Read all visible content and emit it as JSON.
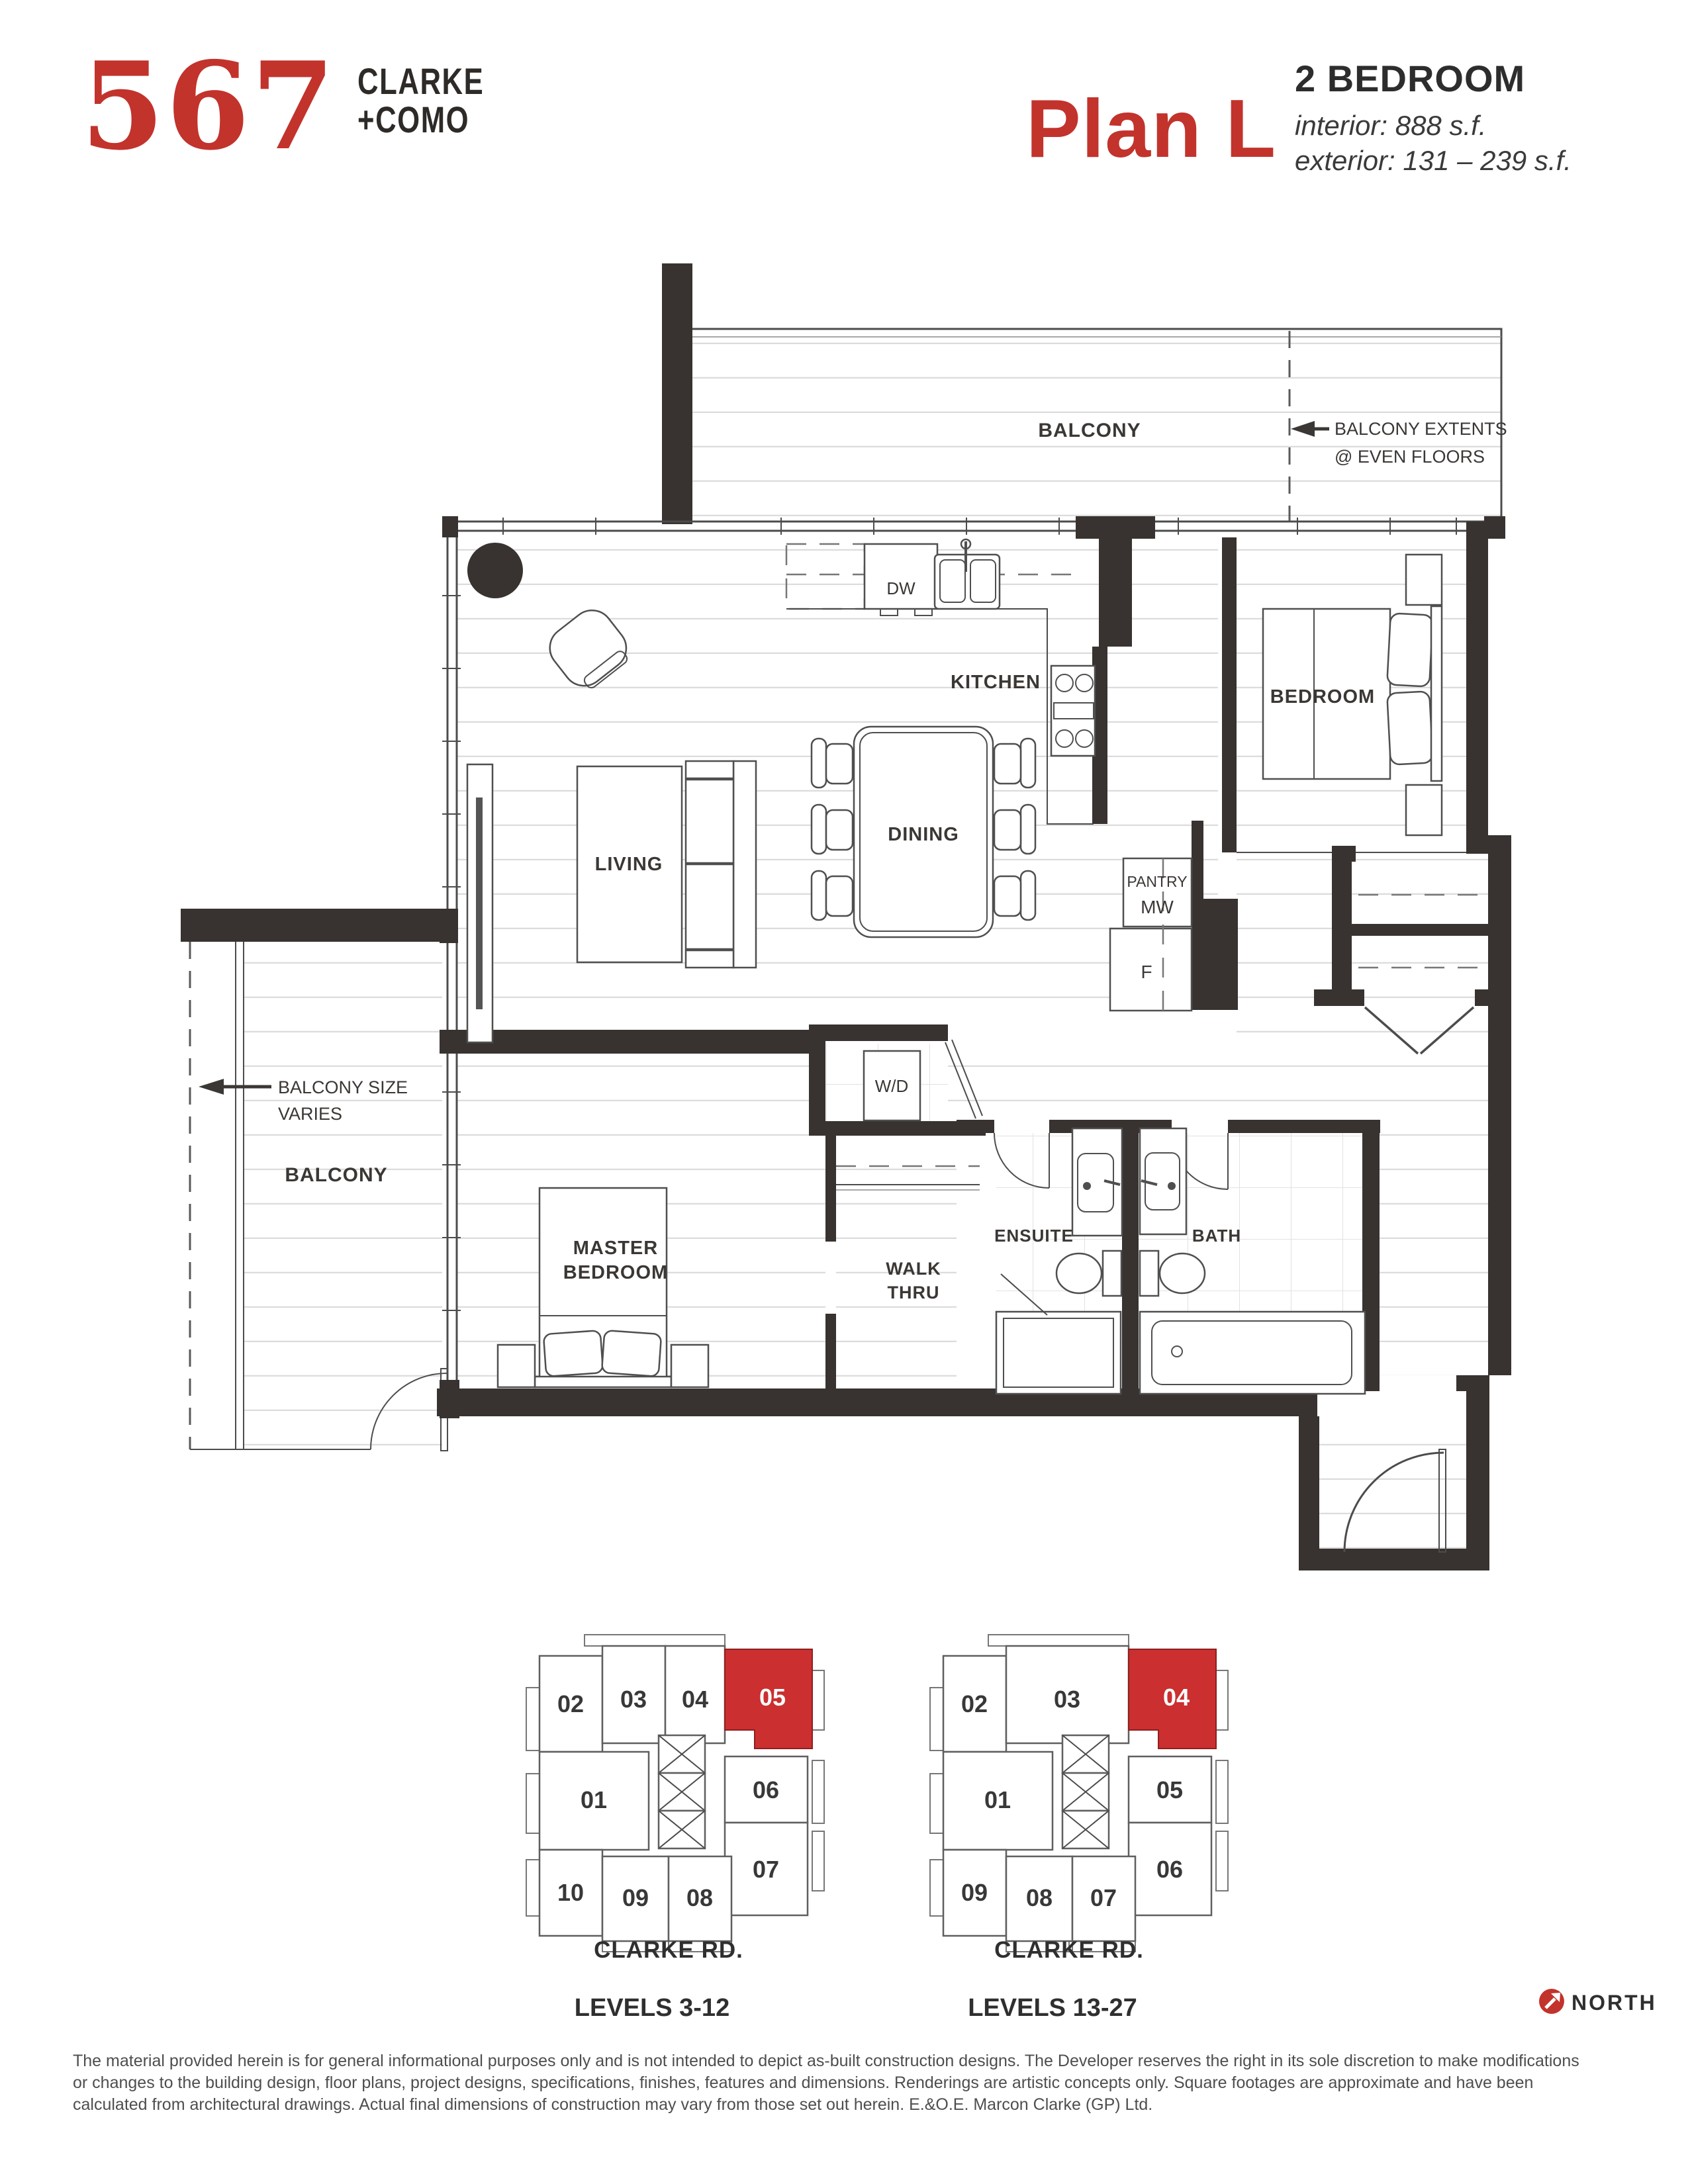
{
  "header": {
    "logo_number": "567",
    "logo_line1": "CLARKE",
    "logo_line2": "+COMO",
    "plan_name": "Plan L",
    "plan_type": "2 BEDROOM",
    "interior": "interior: 888 s.f.",
    "exterior": "exterior: 131 – 239 s.f."
  },
  "plan": {
    "labels": {
      "balcony_top": "BALCONY",
      "extents1": "BALCONY EXTENTS",
      "extents2": "@ EVEN FLOORS",
      "size1": "BALCONY SIZE",
      "size2": "VARIES",
      "balcony_left": "BALCONY",
      "kitchen": "KITCHEN",
      "bedroom": "BEDROOM",
      "dining": "DINING",
      "living": "LIVING",
      "pantry1": "PANTRY",
      "pantry2": "MW",
      "fridge": "F",
      "dishwasher": "DW",
      "washer_dryer": "W/D",
      "master1": "MASTER",
      "master2": "BEDROOM",
      "walk1": "WALK",
      "walk2": "THRU",
      "ensuite": "ENSUITE",
      "bath": "BATH"
    }
  },
  "keyplans": [
    {
      "street": "CLARKE RD.",
      "levels": "LEVELS 3-12",
      "highlighted_unit": "05",
      "units": [
        {
          "label": "02"
        },
        {
          "label": "03"
        },
        {
          "label": "04"
        },
        {
          "label": "05"
        },
        {
          "label": "01"
        },
        {
          "label": "06"
        },
        {
          "label": "07"
        },
        {
          "label": "10"
        },
        {
          "label": "09"
        },
        {
          "label": "08"
        }
      ]
    },
    {
      "street": "CLARKE RD.",
      "levels": "LEVELS 13-27",
      "highlighted_unit": "04",
      "units": [
        {
          "label": "02"
        },
        {
          "label": "03"
        },
        {
          "label": "04"
        },
        {
          "label": "01"
        },
        {
          "label": "05"
        },
        {
          "label": "06"
        },
        {
          "label": "09"
        },
        {
          "label": "08"
        },
        {
          "label": "07"
        }
      ]
    }
  ],
  "compass": {
    "label": "NORTH"
  },
  "disclaimer": {
    "line1": "The material provided herein is for general informational purposes only and is not intended to depict as-built construction designs. The Developer reserves the right in its sole discretion to make modifications",
    "line2": "or changes to the building design, floor plans, project designs, specifications, finishes, features and dimensions. Renderings are artistic concepts only. Square footages are approximate and have been",
    "line3": "calculated from architectural drawings. Actual final dimensions of construction may vary from those set out herein. E.&O.E. Marcon Clarke (GP) Ltd."
  },
  "colors": {
    "accent_red": "#c2332c",
    "keyplan_red": "#cb2f2f",
    "wall": "#383330"
  }
}
